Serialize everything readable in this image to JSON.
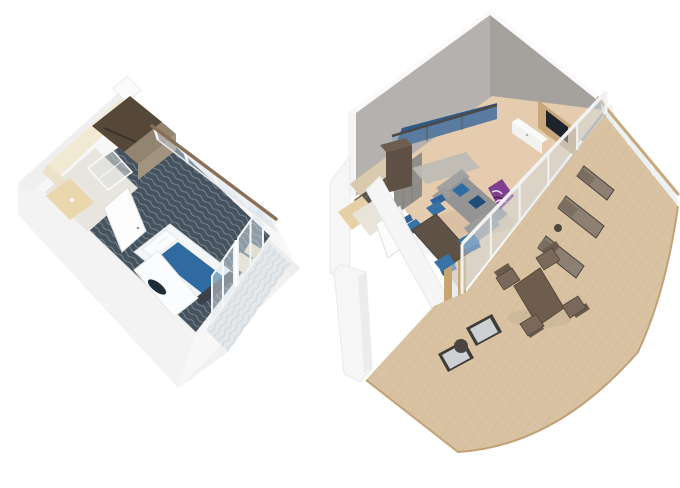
{
  "scene": {
    "background": "#ffffff",
    "subject": "Two isometric 3D stateroom floor plans, no text labels"
  },
  "plans": {
    "stateroom": {
      "name": "balcony-stateroom",
      "items": [
        "outer-walls",
        "bathroom",
        "shower",
        "vanity",
        "wardrobe",
        "closet-cabinet",
        "entry-door",
        "wave-carpet",
        "double-bed",
        "bed-runner",
        "pillows",
        "daybed",
        "bag",
        "foot-bench",
        "corner-armchair",
        "balcony-railing",
        "sliding-glass-doors",
        "balcony-carpet"
      ],
      "colors": {
        "wall_white": "#f7f7f7",
        "carpet": "#46535e",
        "carpet_wave": "#91a3b0",
        "bed_linen": "#f3f5f6",
        "bed_runner": "#2f6aa0",
        "bench": "#3b414b",
        "bag": "#202b38",
        "wardrobe": "#564839",
        "cabinet": "#93846f",
        "bathroom_wall": "#f2e9d3",
        "vanity": "#ead7ad",
        "shower_glass": "rgba(221,225,223,0.55)",
        "armchair": "#e9dab9",
        "railing_wood": "#8a6f55",
        "balcony_carpet": "#e3e7ea",
        "balcony_wave": "#c6cfd5",
        "door_white": "#fdfdfd"
      }
    },
    "loftSuite": {
      "name": "loft-suite-with-large-balcony",
      "items": [
        "tall-gray-walls",
        "loft-bed",
        "loft-balustrade",
        "loft-cabinet",
        "rug",
        "tv-panel",
        "tv",
        "credenza",
        "sectional-sofa",
        "blue-pillows",
        "accent-chair",
        "dining-table",
        "dining-chairs",
        "bathroom",
        "entry-door",
        "wardrobe",
        "glass-wall",
        "balcony-door",
        "wood-deck",
        "deck-railing",
        "loungers",
        "outdoor-dining-set",
        "outdoor-armchairs",
        "side-table"
      ],
      "colors": {
        "wall_left": "#b4b1ae",
        "wall_right": "#a5a29e",
        "floor_wood": "#e6ccae",
        "floor_plank": "#dcbd9c",
        "loft_bed": "#315a86",
        "balustrade_rail": "#4c4a48",
        "balustrade_glass": "rgba(128,156,184,0.5)",
        "loft_cabinet": "#5e5045",
        "rug": "#bcbbb6",
        "tv_panel": "#c9a77c",
        "tv_screen": "#1f242a",
        "credenza": "#f2f2f0",
        "sofa": "#949494",
        "sofa_back": "#a1a1a1",
        "pillow_blue": "#2d6da3",
        "accent_chair": "#813e90",
        "dining_table": "#5e5146",
        "dining_chair": "#3973a5",
        "bathroom_wall": "#d9c9ad",
        "shower_marble": "#5c5449",
        "vanity": "#e6d0a6",
        "door_frame_wood": "#c8a671",
        "wardrobe_gray": "#908d89",
        "glass": "rgba(208,220,230,0.45)",
        "deck_wood": "#d8c2a2",
        "deck_plank": "#c5ac88",
        "deck_edge": "#c2a177",
        "deck_rail_wood": "#c9a87c",
        "lounger": "#8d7f71",
        "lounger_back": "#7b6e61",
        "outdoor_table": "#6e5d4c",
        "outdoor_chair": "#7a695a",
        "armchair_cushion": "#cdd1d4",
        "armchair_frame": "#3f3b37",
        "side_table": "#4b4440"
      }
    }
  }
}
